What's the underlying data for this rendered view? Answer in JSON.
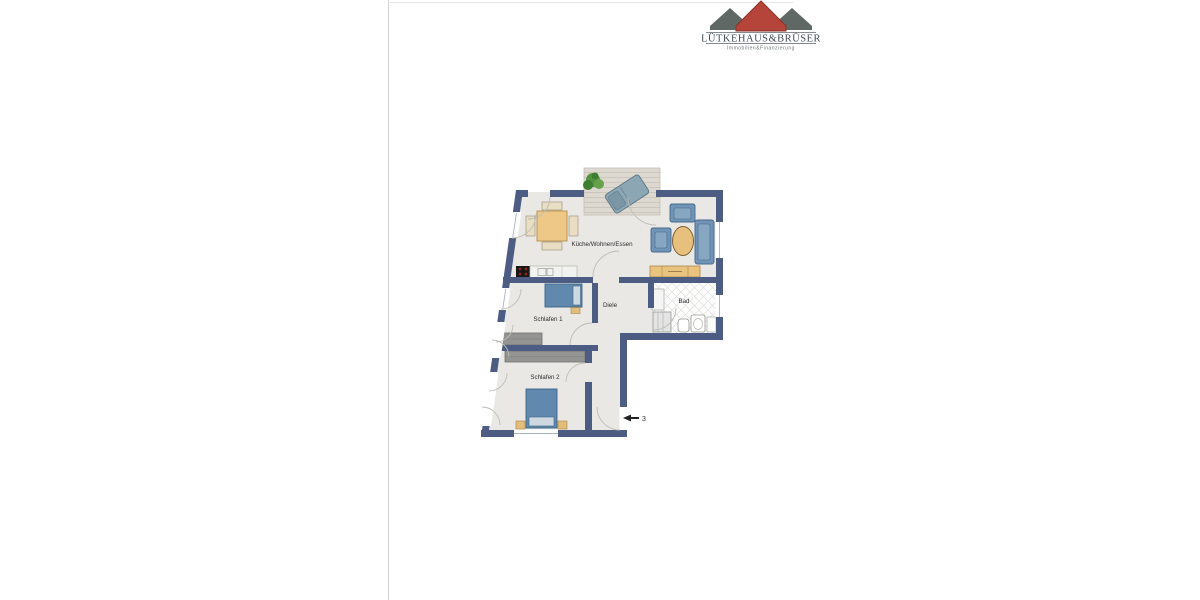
{
  "window": {
    "width": 1200,
    "height": 600,
    "background": "#ffffff"
  },
  "logo": {
    "company_name": "LÜTKEHAUS&BRÜSER",
    "tagline": "Immobilien&Finanzierung",
    "red_roof_color": "#b5453a",
    "gray_roof_color": "#5f6865",
    "text_color": "#414c55"
  },
  "floorplan": {
    "wall_color": "#4d5c83",
    "floor_color": "#e9e8e4",
    "rooms": [
      {
        "id": "kueche-wohnen-essen",
        "label": "Küche/Wohnen/Essen"
      },
      {
        "id": "diele",
        "label": "Diele"
      },
      {
        "id": "bad",
        "label": "Bad"
      },
      {
        "id": "schlafen-1",
        "label": "Schlafen 1"
      },
      {
        "id": "schlafen-2",
        "label": "Schlafen 2"
      }
    ],
    "entrance": {
      "unit_number": "3",
      "arrow_direction": "left"
    },
    "furniture_icons": [
      "plant-icon",
      "sun-lounger-icon",
      "dining-table-icon",
      "chair-icon",
      "stove-icon",
      "kitchen-sink-icon",
      "armchair-icon",
      "coffee-table-icon",
      "sofa-icon",
      "sideboard-icon",
      "bed-icon",
      "wardrobe-icon",
      "shower-icon",
      "toilet-icon",
      "bath-sink-icon"
    ]
  }
}
